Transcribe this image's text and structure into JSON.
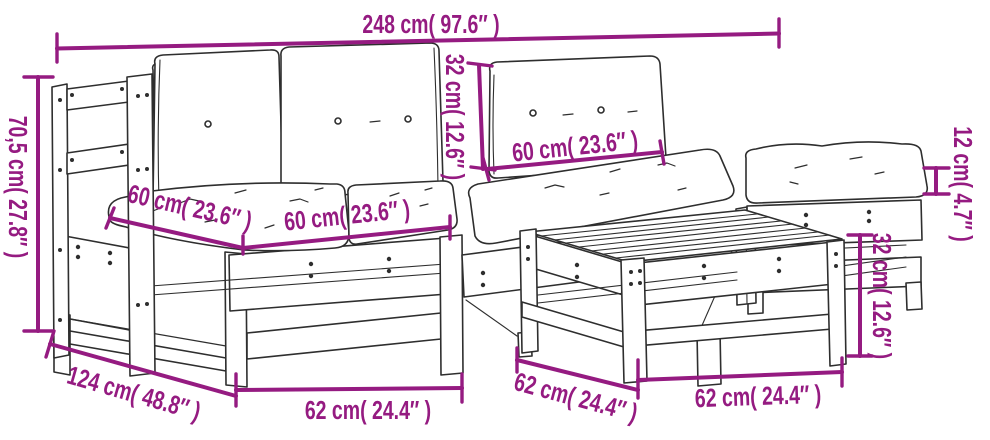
{
  "colors": {
    "dimension": "#951b81",
    "line_art": "#2e2e2e",
    "background": "#ffffff"
  },
  "dimensions": {
    "overall_width": {
      "label": "248 cm( 97.6″ )"
    },
    "overall_height": {
      "label": "70,5 cm( 27.8″ )"
    },
    "back_cushion_height": {
      "label": "32 cm( 12.6″ )"
    },
    "back_cushion_width": {
      "label": "60 cm( 23.6″ )"
    },
    "seat_cushion_depth": {
      "label": "60 cm( 23.6″ )"
    },
    "seat_cushion_width": {
      "label": "60 cm( 23.6″ )"
    },
    "cushion_thickness": {
      "label": "12 cm( 4.7″ )"
    },
    "seat_height": {
      "label": "32 cm( 12.6″ )"
    },
    "overall_depth": {
      "label": "124 cm( 48.8″ )"
    },
    "section_width": {
      "label": "62 cm( 24.4″ )"
    },
    "table_depth": {
      "label": "62 cm( 24.4″ )"
    },
    "table_width": {
      "label": "62 cm( 24.4″ )"
    }
  }
}
